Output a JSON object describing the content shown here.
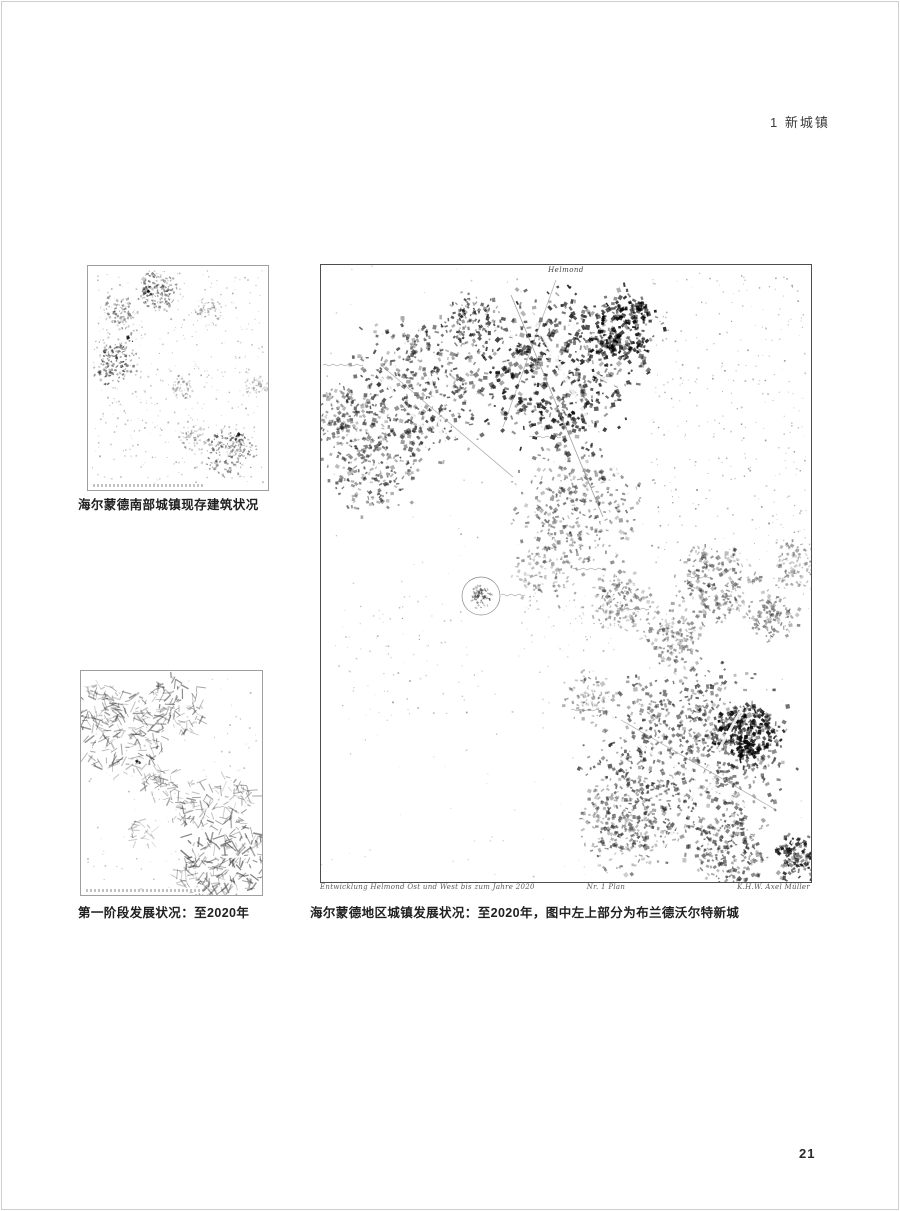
{
  "page": {
    "header": "1 新城镇",
    "page_number": "21"
  },
  "figures": {
    "small_map_existing": {
      "caption": "海尔蒙德南部城镇现存建筑状况"
    },
    "small_map_phase1": {
      "caption": "第一阶段发展状况：至2020年"
    },
    "large_map": {
      "caption": "海尔蒙德地区城镇发展状况：至2020年，图中左上部分为布兰德沃尔特新城",
      "top_label": "Helmond",
      "annotation_left": "Entwicklung Helmond Ost und West bis zum Jahre 2020",
      "annotation_mid": "Nr. 1 Plan",
      "annotation_right": "K.H.W. Axel Müller"
    }
  }
}
